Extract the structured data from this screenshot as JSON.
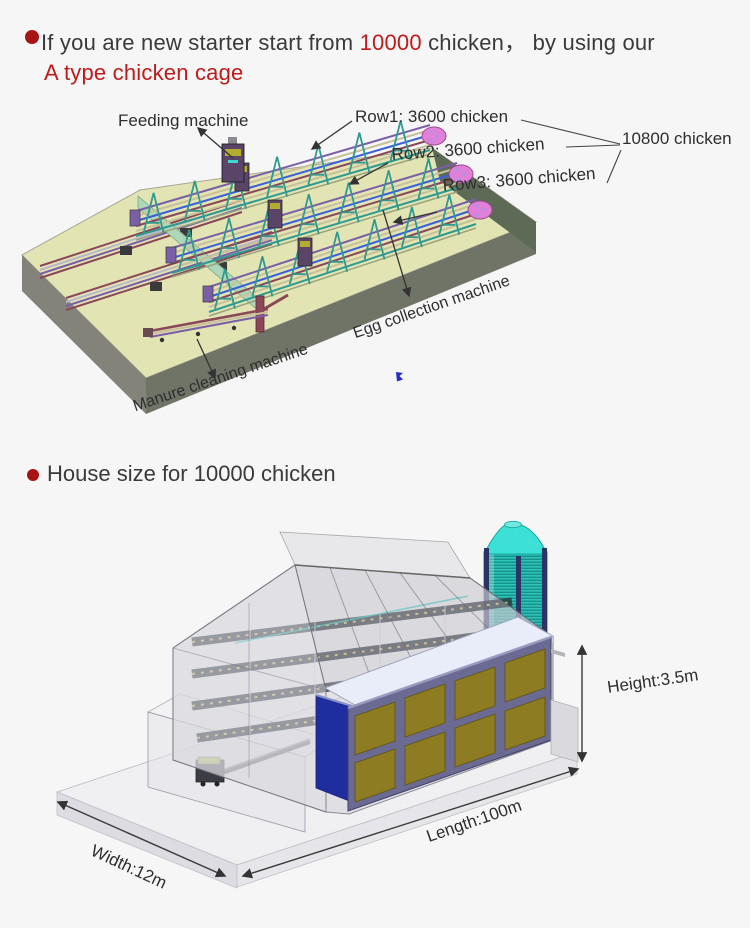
{
  "page": {
    "background": "#f6f6f6"
  },
  "intro": {
    "line1_pre": "If you are new starter start from ",
    "line1_highlight": "10000",
    "line1_post": " chicken，  by using our",
    "line2": "A type chicken cage",
    "accent_color": "#c01a1a",
    "bullet_color": "#a81414",
    "text_color": "#3a3a3a"
  },
  "cage_figure": {
    "labels": {
      "feeding": "Feeding machine",
      "row1": "Row1: 3600 chicken",
      "row2": "Row2: 3600 chicken",
      "row3": "Row3: 3600 chicken",
      "total": "10800 chicken",
      "egg": "Egg collection machine",
      "manure": "Manure cleaning machine"
    },
    "colors": {
      "platform_top": "#e3e4b4",
      "platform_left": "#83837a",
      "platform_front": "#6f7466",
      "platform_right": "#5c6a56",
      "mint_wall": "#aed6b8",
      "cage_teal": "#2f9a8f",
      "cage_maroon": "#8a4757",
      "cage_tan": "#c8c09a",
      "cage_blue": "#3a5fd8",
      "cage_purple": "#7a5fa8",
      "cage_pink": "#e080d8",
      "arrow": "#333333"
    }
  },
  "house_heading": {
    "text": "House size for 10000 chicken"
  },
  "house_figure": {
    "labels": {
      "height": "Height:3.5m",
      "length": "Length:100m",
      "width": "Width:12m"
    },
    "colors": {
      "slab": "#f0f0f2",
      "panel_gold": "#8d7c22",
      "frame_slate": "#6a6a92",
      "navy_wall": "#1f2e9e",
      "eave_band": "#e9edf9",
      "silo_body": "#2cc2b8",
      "silo_cone": "#3ce0d6",
      "building_gray": "#d0d0d6"
    }
  }
}
